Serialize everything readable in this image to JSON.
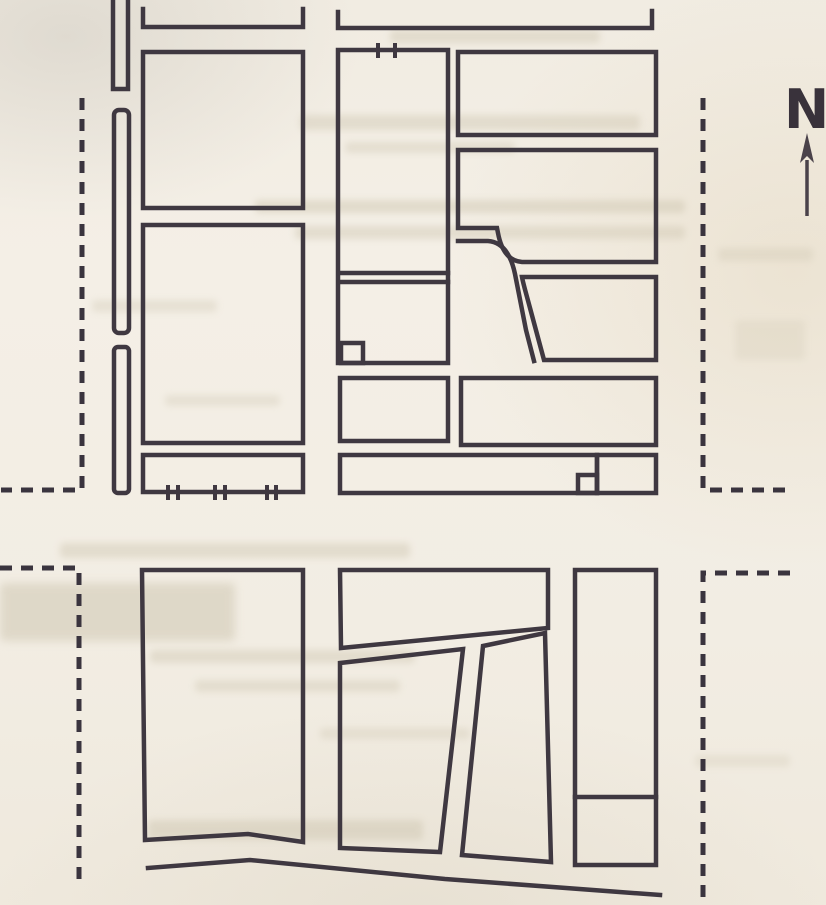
{
  "page": {
    "title": "scanned street map page"
  },
  "compass": {
    "label": "N"
  },
  "colors": {
    "ink": "#3f3841",
    "ink_dash": "#3a343e",
    "paper": "#f2ede3",
    "bleed": "#cfc7b2"
  },
  "map": {
    "stroke_width": 4.5,
    "dash_stroke_width": 5,
    "dash_pattern": "12 9",
    "tick_stroke_width": 4,
    "solid_polylines": [
      {
        "name": "top-street-edge-left",
        "points": "143,9 143,27 303,27 303,9"
      },
      {
        "name": "top-street-edge-right",
        "points": "338,12 338,28 652,28 652,11"
      },
      {
        "name": "north-lane-channel",
        "points": "113,0 113,89 128,89 128,0"
      },
      {
        "name": "bottom-street-edge",
        "points": "148,868 250,860 445,879 660,895"
      }
    ],
    "solid_rects": [
      {
        "name": "median-strip-upper",
        "x": 114,
        "y": 110,
        "w": 15,
        "h": 223,
        "rx": 5
      },
      {
        "name": "median-strip-lower",
        "x": 114,
        "y": 347,
        "w": 15,
        "h": 146,
        "rx": 4
      },
      {
        "name": "block-west-1",
        "x": 143,
        "y": 52,
        "w": 160,
        "h": 156
      },
      {
        "name": "block-west-2",
        "x": 143,
        "y": 225,
        "w": 160,
        "h": 218
      },
      {
        "name": "railway-strip-west",
        "x": 143,
        "y": 455,
        "w": 160,
        "h": 37
      },
      {
        "name": "block-mid-1",
        "x": 338,
        "y": 50,
        "w": 110,
        "h": 313
      },
      {
        "name": "block-mid-1-corner-lot",
        "x": 341,
        "y": 343,
        "w": 22,
        "h": 20
      },
      {
        "name": "block-mid-2",
        "x": 340,
        "y": 378,
        "w": 108,
        "h": 63
      },
      {
        "name": "strip-central",
        "x": 340,
        "y": 455,
        "w": 257,
        "h": 38
      },
      {
        "name": "strip-east-box",
        "x": 597,
        "y": 455,
        "w": 59,
        "h": 38
      },
      {
        "name": "strip-small-lot",
        "x": 578,
        "y": 475,
        "w": 19,
        "h": 18
      },
      {
        "name": "block-east-1",
        "x": 458,
        "y": 52,
        "w": 198,
        "h": 83
      },
      {
        "name": "block-east-4",
        "x": 461,
        "y": 378,
        "w": 195,
        "h": 67
      },
      {
        "name": "block-southeast-column",
        "x": 575,
        "y": 570,
        "w": 81,
        "h": 295
      }
    ],
    "solid_polygons": [
      {
        "name": "block-southwest",
        "points": "142,570 303,570 303,842 248,834 145,840"
      },
      {
        "name": "block-south-mid-1",
        "points": "340,570 548,570 548,628 341,648"
      },
      {
        "name": "block-south-mid-2",
        "points": "340,663 463,649 440,852 340,848"
      },
      {
        "name": "block-south-mid-3",
        "points": "483,646 545,633 551,862 462,855"
      }
    ],
    "solid_paths": [
      {
        "name": "block-east-2-bent",
        "d": "M458,150 L656,150 L656,262 L522,262 C508,261 501,249 498,233 L497,228 L458,228 Z"
      },
      {
        "name": "curved-road-west-edge",
        "d": "M458,241 L488,241 C503,242 511,255 515,274 L526,330 L534,361"
      },
      {
        "name": "block-east-3-curved",
        "d": "M522,277 L656,277 L656,360 L544,360 L530,308 C526,293 523,283 522,277 Z"
      }
    ],
    "solid_lines": [
      {
        "name": "alley-north-edge",
        "x1": 339,
        "y1": 273,
        "x2": 448,
        "y2": 273
      },
      {
        "name": "alley-south-edge",
        "x1": 339,
        "y1": 282,
        "x2": 448,
        "y2": 282
      },
      {
        "name": "southeast-column-divider",
        "x1": 575,
        "y1": 797,
        "x2": 656,
        "y2": 797
      }
    ],
    "dashed_polylines": [
      {
        "name": "map-boundary-west-upper",
        "points": "82,98 82,490 1,490"
      },
      {
        "name": "map-boundary-west-lower",
        "points": "0,568 79,568 79,886"
      },
      {
        "name": "map-boundary-east-upper",
        "points": "703,98 703,490 789,490"
      },
      {
        "name": "map-boundary-east-lower",
        "points": "790,573 703,573 703,897"
      }
    ],
    "railway_ticks": [
      {
        "name": "railway-tick",
        "x": 168,
        "y1": 485,
        "y2": 500
      },
      {
        "name": "railway-tick",
        "x": 178,
        "y1": 485,
        "y2": 500
      },
      {
        "name": "railway-tick",
        "x": 215,
        "y1": 485,
        "y2": 500
      },
      {
        "name": "railway-tick",
        "x": 225,
        "y1": 485,
        "y2": 500
      },
      {
        "name": "railway-tick",
        "x": 267,
        "y1": 485,
        "y2": 500
      },
      {
        "name": "railway-tick",
        "x": 276,
        "y1": 485,
        "y2": 500
      },
      {
        "name": "gate-tick",
        "x": 378,
        "y1": 43,
        "y2": 58
      },
      {
        "name": "gate-tick",
        "x": 395,
        "y1": 43,
        "y2": 58
      }
    ],
    "bleedthrough_smudges": [
      {
        "x": 390,
        "y": 30,
        "w": 210,
        "h": 13,
        "o": 0.45
      },
      {
        "x": 300,
        "y": 115,
        "w": 340,
        "h": 15,
        "o": 0.45
      },
      {
        "x": 345,
        "y": 142,
        "w": 170,
        "h": 11,
        "o": 0.4
      },
      {
        "x": 255,
        "y": 200,
        "w": 430,
        "h": 13,
        "o": 0.5
      },
      {
        "x": 295,
        "y": 226,
        "w": 390,
        "h": 13,
        "o": 0.45
      },
      {
        "x": 718,
        "y": 248,
        "w": 95,
        "h": 13,
        "o": 0.35
      },
      {
        "x": 92,
        "y": 300,
        "w": 125,
        "h": 12,
        "o": 0.35
      },
      {
        "x": 735,
        "y": 320,
        "w": 70,
        "h": 40,
        "o": 0.25
      },
      {
        "x": 165,
        "y": 395,
        "w": 115,
        "h": 11,
        "o": 0.35
      },
      {
        "x": 60,
        "y": 543,
        "w": 350,
        "h": 15,
        "o": 0.45
      },
      {
        "x": 0,
        "y": 583,
        "w": 235,
        "h": 58,
        "o": 0.55,
        "big": true
      },
      {
        "x": 150,
        "y": 650,
        "w": 265,
        "h": 13,
        "o": 0.45
      },
      {
        "x": 195,
        "y": 680,
        "w": 205,
        "h": 12,
        "o": 0.4
      },
      {
        "x": 320,
        "y": 728,
        "w": 150,
        "h": 11,
        "o": 0.35
      },
      {
        "x": 148,
        "y": 820,
        "w": 275,
        "h": 20,
        "o": 0.5
      },
      {
        "x": 695,
        "y": 755,
        "w": 95,
        "h": 12,
        "o": 0.3
      }
    ]
  }
}
